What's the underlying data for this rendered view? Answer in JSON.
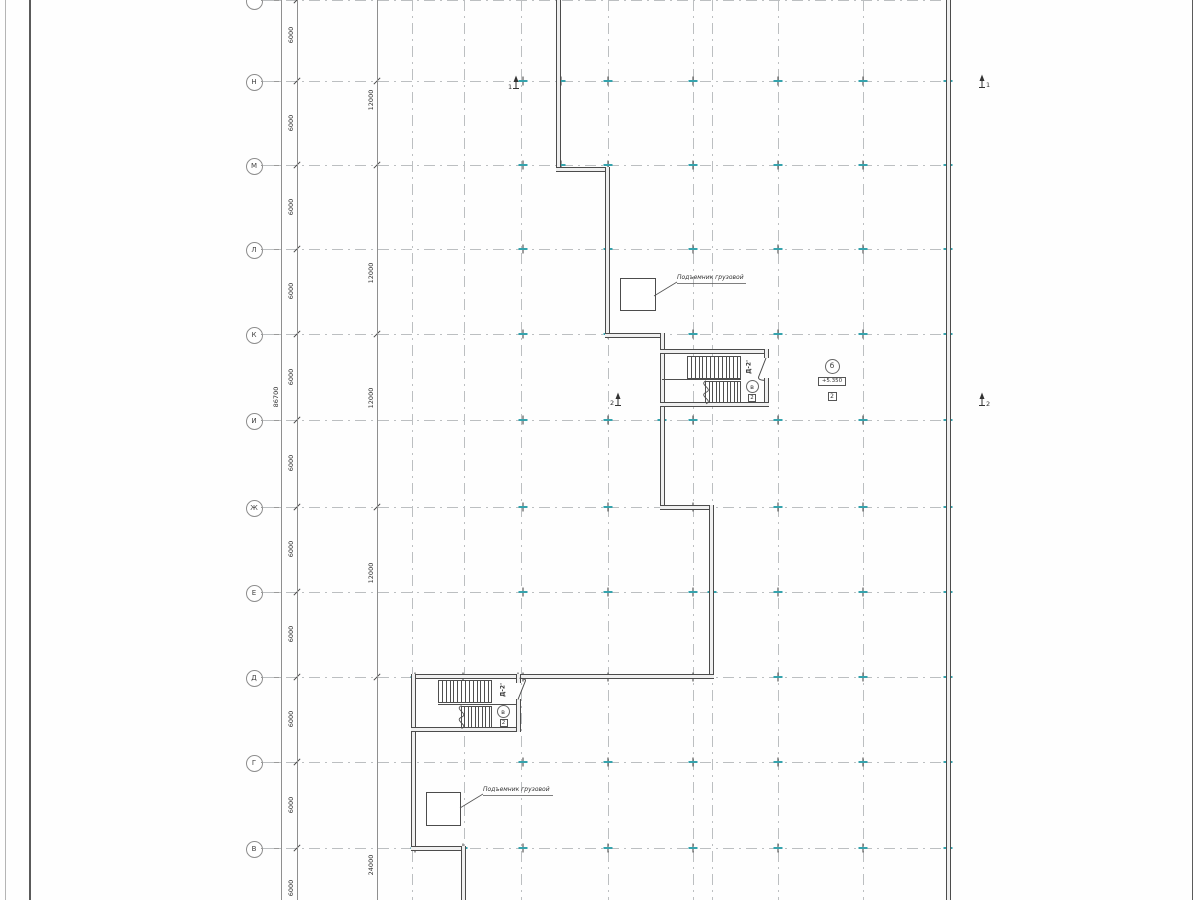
{
  "sheet": {
    "width": 1200,
    "height": 900
  },
  "axes": {
    "rows": [
      {
        "label": "",
        "y": 0
      },
      {
        "label": "Н",
        "y": 81
      },
      {
        "label": "М",
        "y": 165
      },
      {
        "label": "Л",
        "y": 249
      },
      {
        "label": "К",
        "y": 334
      },
      {
        "label": "И",
        "y": 420
      },
      {
        "label": "Ж",
        "y": 507
      },
      {
        "label": "Е",
        "y": 592
      },
      {
        "label": "Д",
        "y": 677
      },
      {
        "label": "Г",
        "y": 762
      },
      {
        "label": "В",
        "y": 848
      }
    ],
    "column_lines_x": [
      412,
      464,
      521,
      608,
      693,
      712,
      778,
      863,
      948
    ],
    "tick_columns_x": [
      523,
      608,
      693,
      778,
      863,
      948
    ],
    "extra_ticks": [
      [
        561,
        81
      ],
      [
        561,
        165
      ],
      [
        662,
        420
      ],
      [
        712,
        592
      ],
      [
        415,
        677
      ],
      [
        463,
        677
      ],
      [
        518,
        677
      ],
      [
        415,
        848
      ],
      [
        463,
        848
      ]
    ]
  },
  "dimensions": {
    "chain_6000": {
      "label": "6000",
      "ys": [
        35,
        123,
        207,
        291,
        377,
        463,
        549,
        634,
        719,
        805,
        888
      ]
    },
    "chain_12000": [
      {
        "label": "12000",
        "y": 100
      },
      {
        "label": "12000",
        "y": 273
      },
      {
        "label": "12000",
        "y": 398
      },
      {
        "label": "12000",
        "y": 573
      },
      {
        "label": "24000",
        "y": 865
      }
    ],
    "overall": {
      "label": "86700",
      "y": 397
    },
    "tick_rows_12000": [
      81,
      165,
      334,
      507,
      677
    ]
  },
  "annotations": {
    "hoist_upper": {
      "text": "Подъемник грузовой"
    },
    "hoist_lower": {
      "text": "Подъемник грузовой"
    },
    "stair_upper": {
      "door": "Д-2'",
      "ref": "в",
      "num": "2"
    },
    "stair_lower": {
      "door": "Д-2'",
      "ref": "в",
      "num": "2"
    },
    "level_mark": {
      "ref": "б",
      "elevation": "+5.350",
      "num": "2"
    },
    "sections": {
      "s1": "1",
      "s2": "2"
    }
  },
  "stairs": {
    "upper": {
      "flight1": {
        "x1": 687,
        "x2": 741,
        "y1": 356,
        "y2": 379,
        "n": 13
      },
      "flight2": {
        "x1": 705,
        "x2": 741,
        "y1": 381,
        "y2": 403,
        "n": 9
      },
      "midline": {
        "x1": 662,
        "x2": 741,
        "y": 379
      }
    },
    "lower": {
      "flight1": {
        "x1": 438,
        "x2": 492,
        "y1": 680,
        "y2": 703,
        "n": 13
      },
      "flight2": {
        "x1": 461,
        "x2": 492,
        "y1": 706,
        "y2": 728,
        "n": 8
      },
      "midline": {
        "x1": 438,
        "x2": 516,
        "y": 704
      }
    }
  }
}
